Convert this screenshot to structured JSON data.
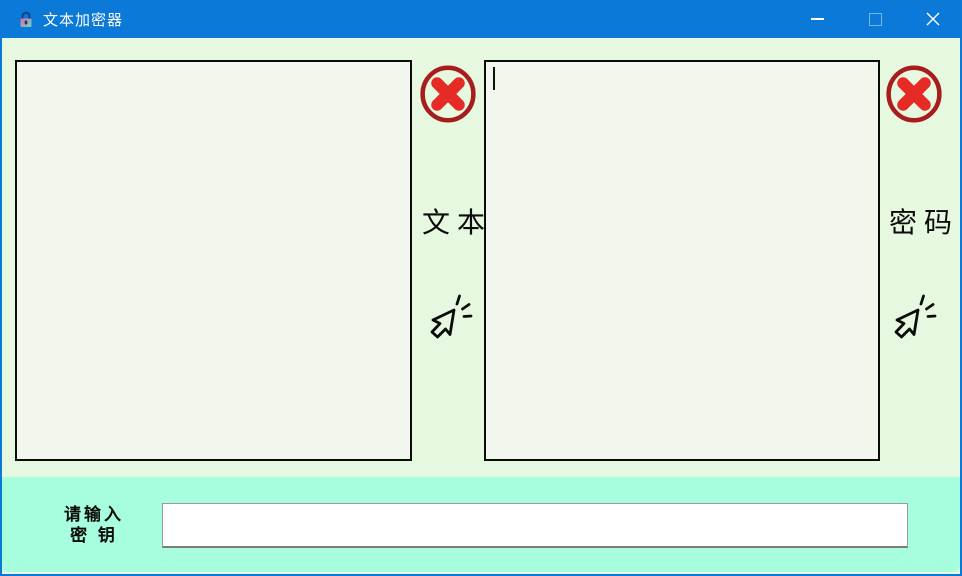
{
  "window": {
    "title": "文本加密器",
    "controls": {
      "minimize_icon": "minimize",
      "maximize_icon": "maximize",
      "close_icon": "close"
    }
  },
  "panels": {
    "text": {
      "label": "文本",
      "value": "",
      "clear_icon": "red-x-clear",
      "click_icon": "click-cursor"
    },
    "cipher": {
      "label": "密码",
      "value": "",
      "clear_icon": "red-x-clear",
      "click_icon": "click-cursor"
    }
  },
  "key_input": {
    "label_line1": "请输入",
    "label_line2": "密 钥",
    "value": "",
    "placeholder": ""
  },
  "colors": {
    "titlebar_blue": "#0a79d8",
    "body_green": "#e6f9e0",
    "textbox_fill": "#f1f7ec",
    "textbox_border": "#0b0b0b",
    "key_panel_aqua": "#a6fede",
    "clear_ring_red": "#a81c1c",
    "clear_x_red": "#e62b26"
  }
}
